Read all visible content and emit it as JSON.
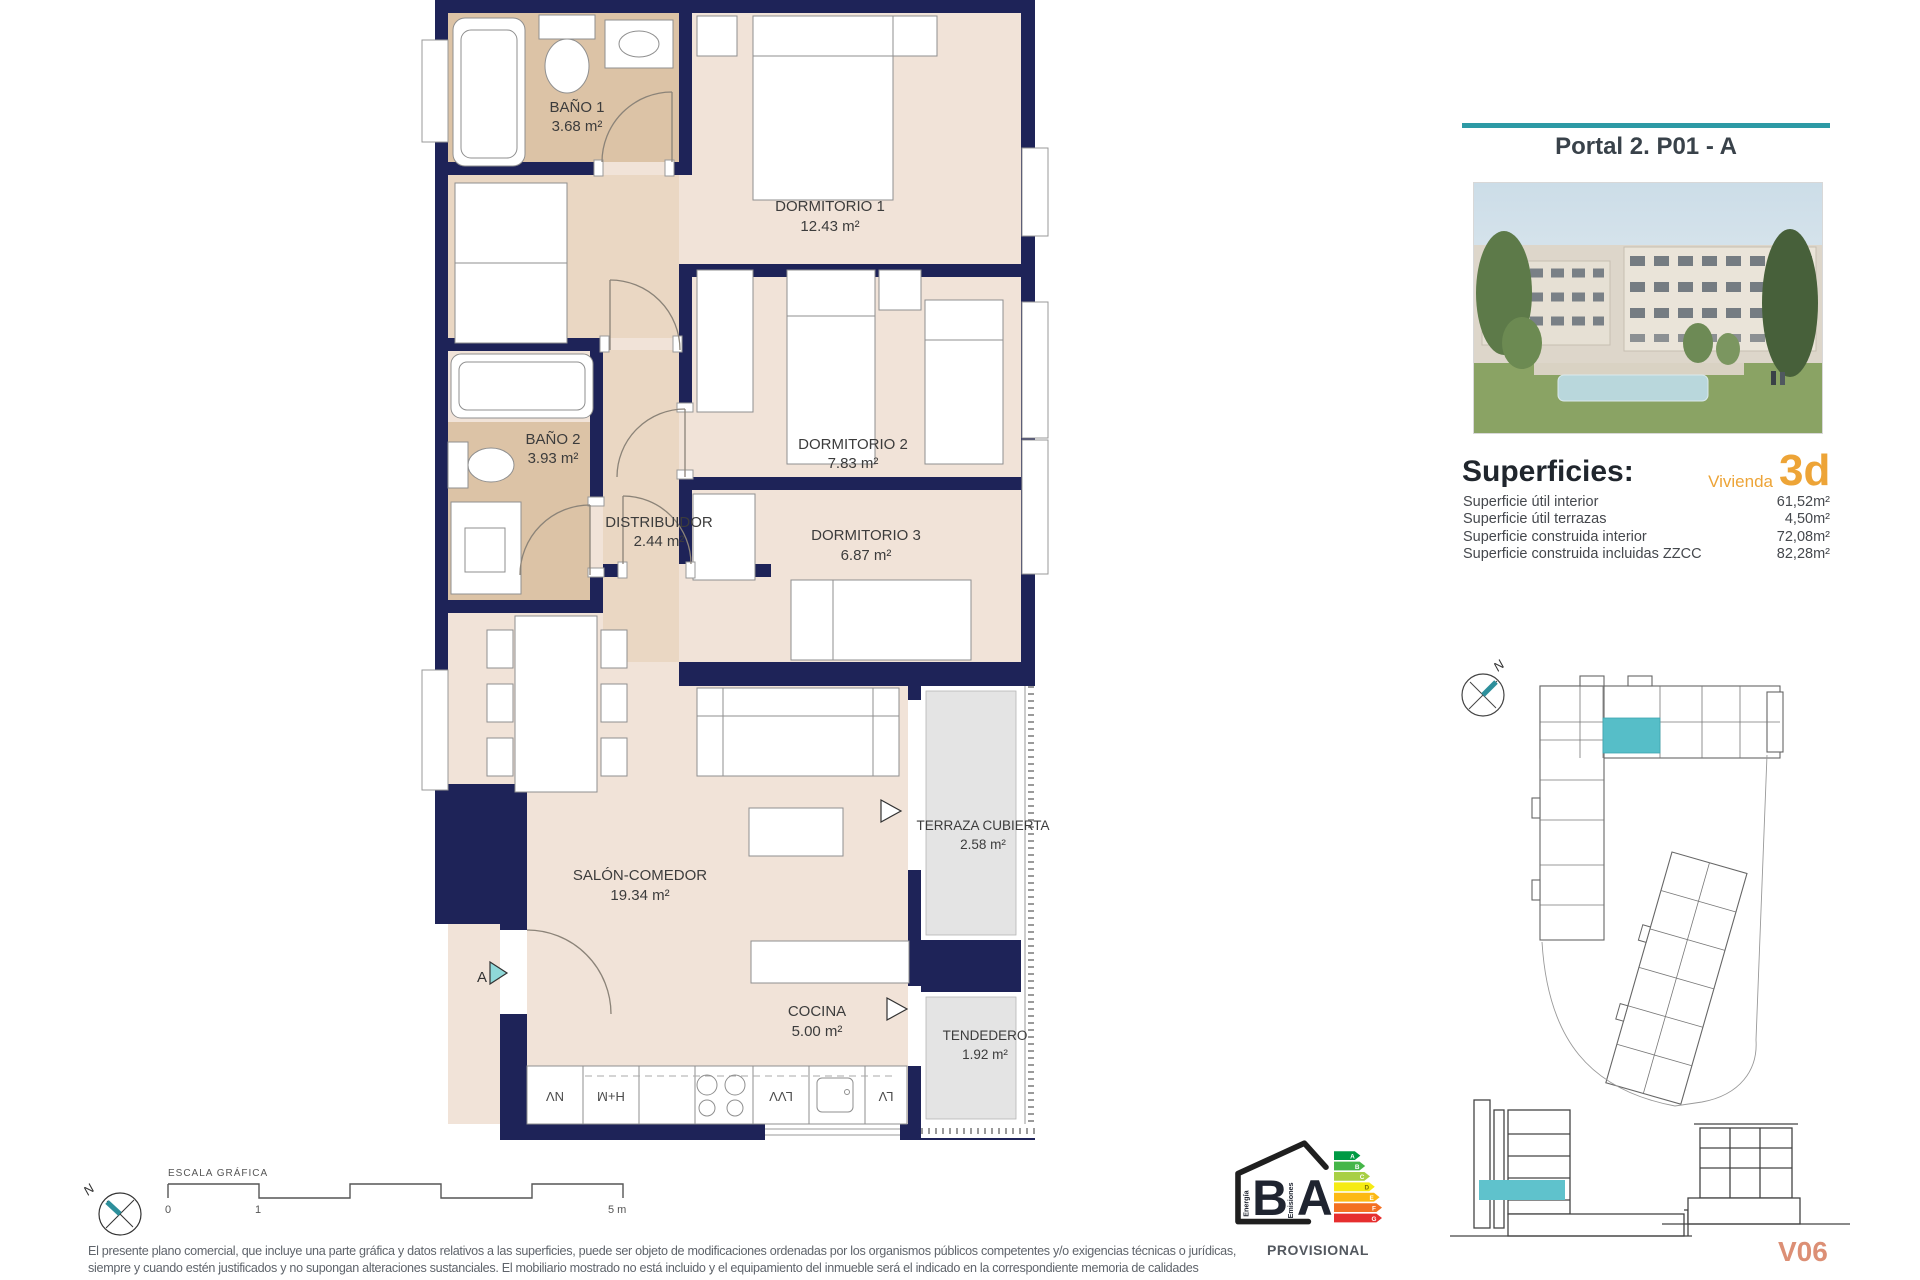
{
  "header": {
    "title": "Portal 2. P01 - A"
  },
  "superficies": {
    "heading": "Superficies:",
    "vivienda_label": "Vivienda",
    "vivienda_type": "3d",
    "rows": [
      {
        "label": "Superficie útil interior",
        "value": "61,52m²"
      },
      {
        "label": "Superficie útil terrazas",
        "value": "4,50m²"
      },
      {
        "label": "Superficie construida interior",
        "value": "72,08m²"
      },
      {
        "label": "Superficie construida incluidas ZZCC",
        "value": "82,28m²"
      }
    ]
  },
  "plan": {
    "rooms": {
      "banio1": {
        "name": "BAÑO 1",
        "area": "3.68 m²"
      },
      "dormitorio1": {
        "name": "DORMITORIO 1",
        "area": "12.43 m²"
      },
      "banio2": {
        "name": "BAÑO 2",
        "area": "3.93 m²"
      },
      "dormitorio2": {
        "name": "DORMITORIO 2",
        "area": "7.83 m²"
      },
      "distribuidor": {
        "name": "DISTRIBUIDOR",
        "area": "2.44 m²"
      },
      "dormitorio3": {
        "name": "DORMITORIO 3",
        "area": "6.87 m²"
      },
      "salon": {
        "name": "SALÓN-COMEDOR",
        "area": "19.34 m²"
      },
      "cocina": {
        "name": "COCINA",
        "area": "5.00 m²"
      },
      "terraza": {
        "name": "TERRAZA CUBIERTA",
        "area": "2.58 m²"
      },
      "tendedero": {
        "name": "TENDEDERO",
        "area": "1.92 m²"
      }
    },
    "entry_marker": "A",
    "appliances": [
      "NV",
      "H+M",
      "LVV",
      "LV"
    ]
  },
  "site_plan": {
    "north": "N"
  },
  "scale_bar": {
    "label": "ESCALA GRÁFICA",
    "tick0": "0",
    "tick1": "1",
    "tick5": "5 m"
  },
  "compass": {
    "north": "N"
  },
  "energy": {
    "letter_left": "B",
    "letter_right": "A",
    "word_left": "Energía",
    "word_right": "Emisiones",
    "scale": [
      "A",
      "B",
      "C",
      "D",
      "E",
      "F",
      "G"
    ],
    "scale_colors": [
      "#009a44",
      "#45b649",
      "#a8cf45",
      "#f6eb14",
      "#fdb913",
      "#f37021",
      "#e62e2e"
    ],
    "status": "PROVISIONAL"
  },
  "footer": {
    "disclaimer_line1": "El presente plano comercial, que incluye una parte gráfica y datos relativos a las superficies, puede ser objeto de modificaciones ordenadas por los organismos públicos competentes y/o exigencias técnicas o jurídicas,",
    "disclaimer_line2": "siempre y cuando estén justificados y no supongan alteraciones sustanciales. El mobiliario mostrado no está incluido y el equipamiento del inmueble será el indicado en la correspondiente memoria de calidades",
    "plan_code": "V06"
  },
  "colors": {
    "teal": "#2d9aa5",
    "orange": "#eda437",
    "salmon": "#dc8f75",
    "wall_navy": "#1e2358",
    "floor_beige": "#f1e3d8",
    "hall_beige": "#ead7c3",
    "bath_tan": "#dcc3a6",
    "terrace_gray": "#e4e4e4",
    "unit_teal": "#56bec8"
  }
}
